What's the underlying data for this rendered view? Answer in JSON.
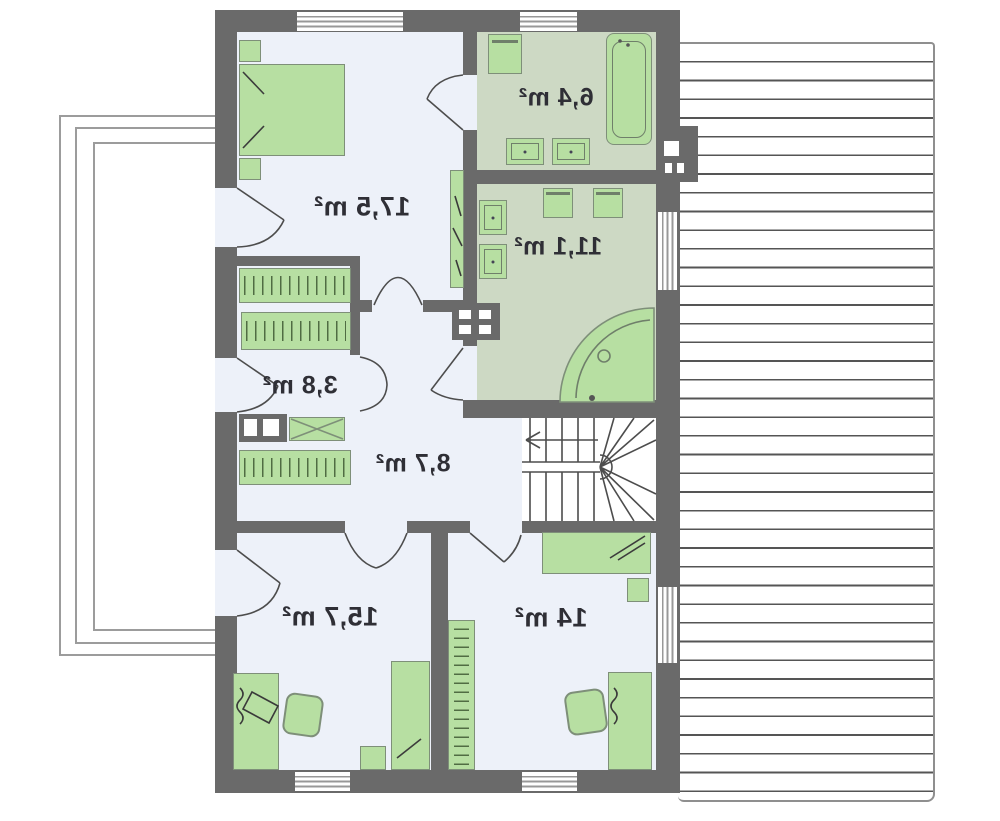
{
  "plan": {
    "type": "residential-floor-plan",
    "labels_mirrored": true,
    "rooms": [
      {
        "id": "bedroom-top-left",
        "area_label": "17,5 m²"
      },
      {
        "id": "bathroom-small",
        "area_label": "6,4 m²"
      },
      {
        "id": "bathroom-large",
        "area_label": "11,1 m²"
      },
      {
        "id": "wardrobe-closet",
        "area_label": "3,8 m²"
      },
      {
        "id": "hall-landing",
        "area_label": "8,7 m²"
      },
      {
        "id": "bedroom-bottom-left",
        "area_label": "15,7 m²"
      },
      {
        "id": "bedroom-bottom-right",
        "area_label": "14 m²"
      }
    ],
    "colors": {
      "wall": "#6a6a6a",
      "room_floor": "#edf1f9",
      "bathroom_floor": "#cdd9c4",
      "furniture_fill": "#b7dfa2",
      "furniture_stroke": "#7e8f79",
      "roof_line": "#555555",
      "label_text": "#2f2f36"
    }
  }
}
